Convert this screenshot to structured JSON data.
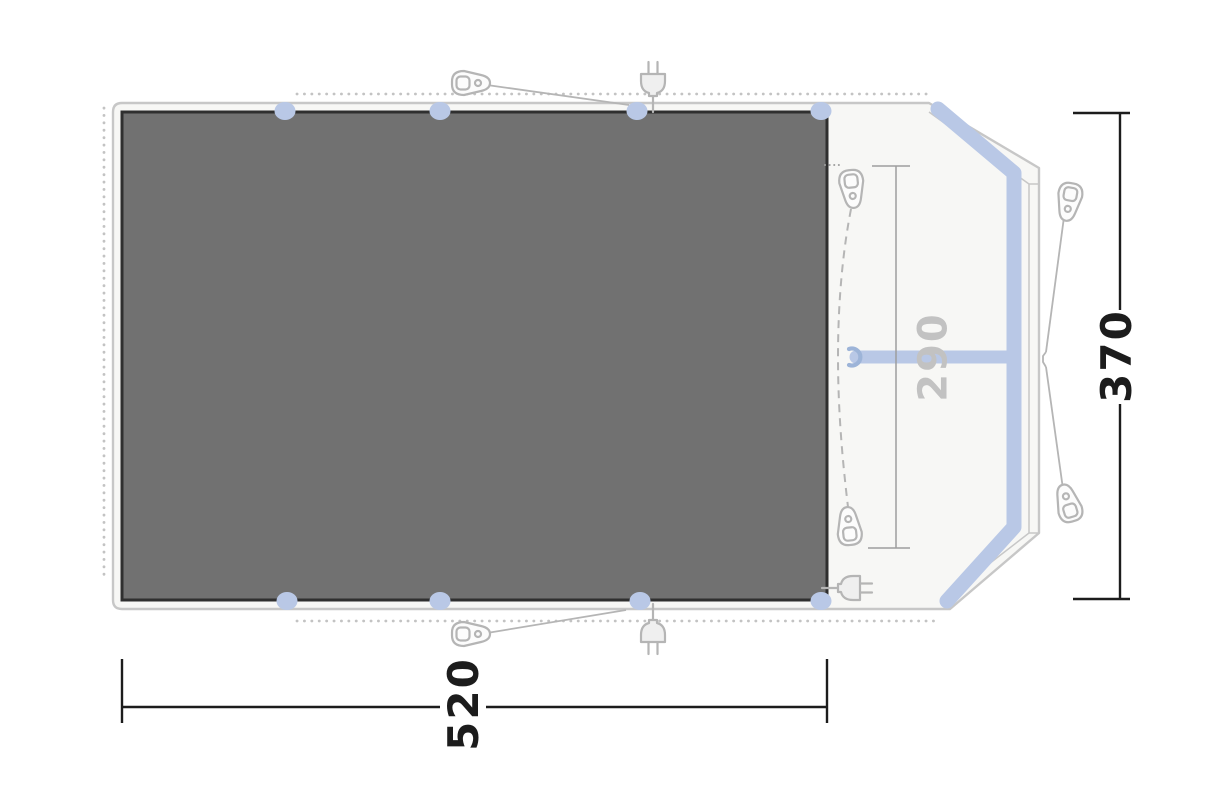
{
  "diagram": {
    "kind": "tent-floorplan-top-view",
    "labels": {
      "total_width": "520",
      "total_depth": "370",
      "porch_width": "290"
    },
    "colors": {
      "background": "#ffffff",
      "canvas_fill": "#f7f7f5",
      "outline": "#c7c7c7",
      "icon_gray": "#b5b5b5",
      "dots": "#c3c3c3",
      "groundsheet_fill": "#717171",
      "groundsheet_border": "#2f2f2f",
      "pole_blue": "#b9c8e6",
      "hook_blue": "#9db4d8",
      "dim_line": "#1c1c1c",
      "inner_dim_line": "#9e9e9e",
      "inner_dim_label": "#c2c2c2"
    },
    "icons": {
      "tent_peg_icons": 6,
      "power_plug_icons": 3,
      "pole_tab_icons": 8
    }
  }
}
